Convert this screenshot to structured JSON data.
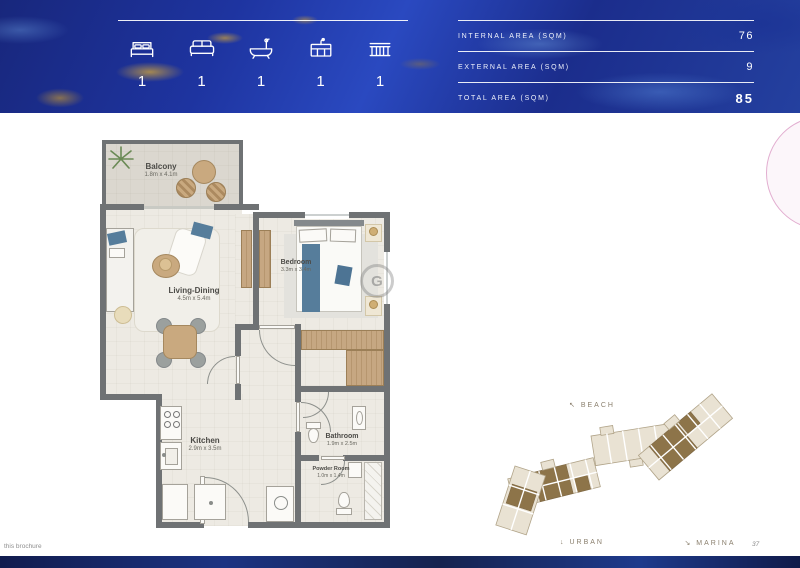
{
  "header": {
    "stats": [
      {
        "icon": "bed-icon",
        "count": "1"
      },
      {
        "icon": "sofa-icon",
        "count": "1"
      },
      {
        "icon": "bathtub-icon",
        "count": "1"
      },
      {
        "icon": "kitchen-icon",
        "count": "1"
      },
      {
        "icon": "balcony-icon",
        "count": "1"
      }
    ],
    "area_table": {
      "rows": [
        {
          "label": "INTERNAL AREA (SQM)",
          "value": "76"
        },
        {
          "label": "EXTERNAL AREA (SQM)",
          "value": "9"
        },
        {
          "label": "TOTAL AREA (SQM)",
          "value": "85"
        }
      ]
    }
  },
  "floorplan": {
    "rooms": [
      {
        "name": "Balcony",
        "dims": "1.8m x 4.1m"
      },
      {
        "name": "Living-Dining",
        "dims": "4.5m x 5.4m"
      },
      {
        "name": "Bedroom",
        "dims": "3.3m x 3.4m"
      },
      {
        "name": "Kitchen",
        "dims": "2.9m x 3.5m"
      },
      {
        "name": "Bathroom",
        "dims": "1.9m x 2.5m"
      },
      {
        "name": "Powder Room",
        "dims": "1.0m x 1.4m"
      }
    ],
    "watermark": "G"
  },
  "siteplan": {
    "labels": [
      {
        "arrow": "↖",
        "text": "BEACH"
      },
      {
        "arrow": "↓",
        "text": "URBAN"
      },
      {
        "arrow": "↘",
        "text": "MARINA"
      }
    ]
  },
  "footer": {
    "note": "this brochure",
    "page_number": "37"
  },
  "colors": {
    "header_navy": "#1d3190",
    "gold": "#a9874b",
    "wall_gray": "#6f7274",
    "wood": "#c3a480",
    "accent_blue": "#567d9b",
    "site_brown": "#8d7449",
    "pink": "#e2aed0"
  }
}
